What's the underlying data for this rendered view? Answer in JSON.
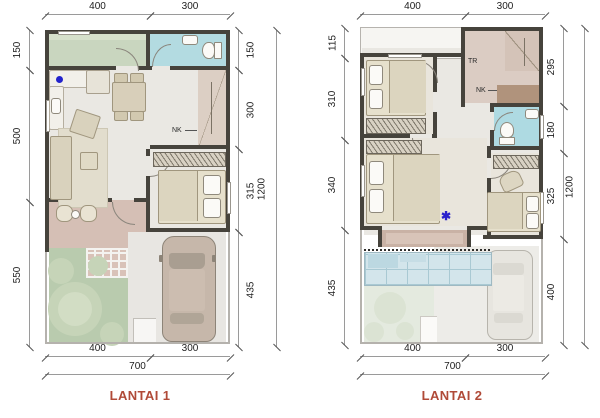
{
  "plan1": {
    "title": "LANTAI 1",
    "dims": {
      "top": [
        "400",
        "300"
      ],
      "bottom": [
        "400",
        "300"
      ],
      "bottom_total": "700",
      "left": [
        "150",
        "500",
        "550"
      ],
      "right": [
        "150",
        "300",
        "315",
        "435"
      ],
      "right_total": "1200"
    },
    "labels": {
      "stairs_note": "NK"
    }
  },
  "plan2": {
    "title": "LANTAI 2",
    "dims": {
      "top": [
        "400",
        "300"
      ],
      "bottom": [
        "400",
        "300"
      ],
      "bottom_total": "700",
      "left": [
        "115",
        "310",
        "340",
        "435"
      ],
      "right": [
        "295",
        "180",
        "325",
        "400"
      ],
      "right_total": "1200"
    },
    "labels": {
      "stairs_note_upper": "TR",
      "stairs_note_lower": "NK"
    },
    "markers": {
      "bedroom_asterisk": "✱"
    }
  },
  "colors": {
    "title_accent": "#b04a38",
    "marker_blue": "#2222cc",
    "wall": "#46433c",
    "bathroom": "#b3dbe1",
    "service_room": "#c9d6bf",
    "garden": "#b9cbae",
    "terrace": "#d5bfb5",
    "stairs": "#dccfc4",
    "canopy": "#d3e5eb"
  }
}
